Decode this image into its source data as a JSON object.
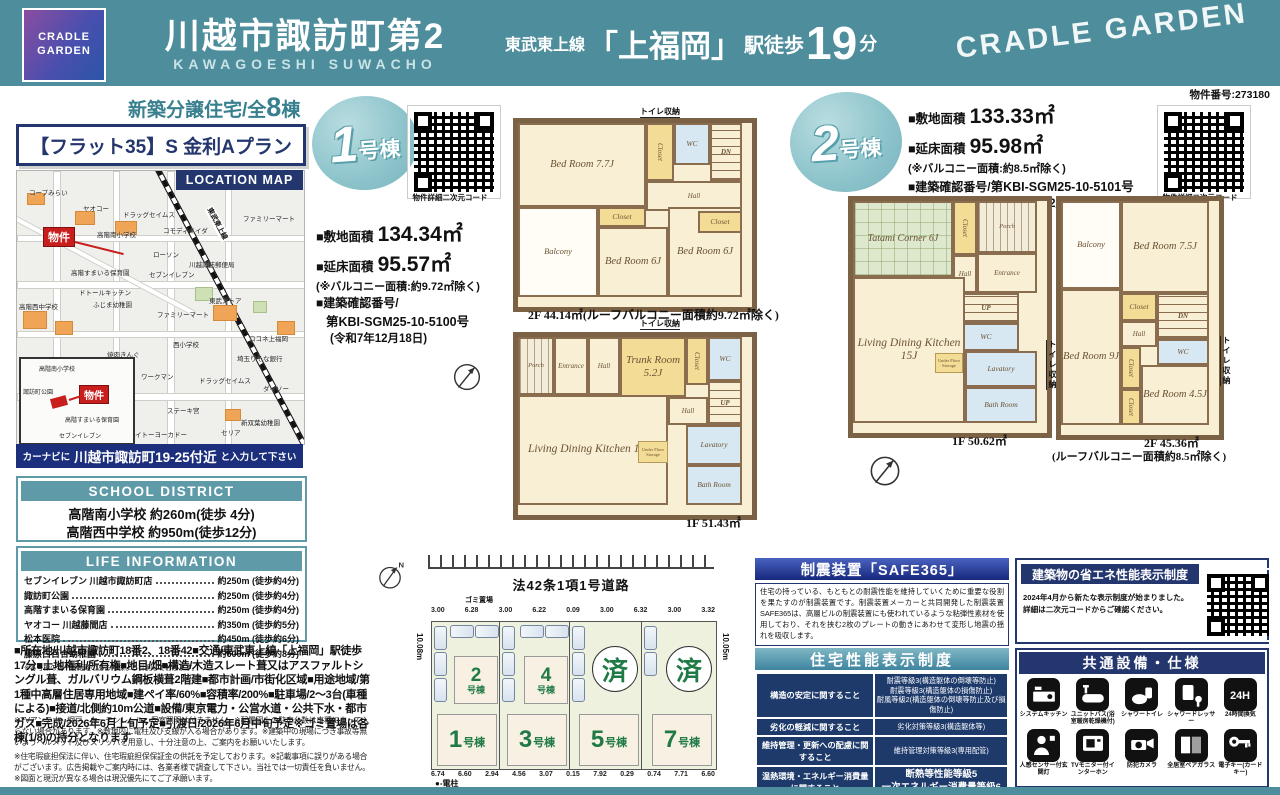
{
  "colors": {
    "teal": "#4e8e9c",
    "navy": "#24366e",
    "green": "#1f7a46",
    "red": "#c81e1e"
  },
  "header": {
    "logo_line1": "CRADLE",
    "logo_line2": "GARDEN",
    "title": "川越市諏訪町第2",
    "subtitle": "KAWAGOESHI SUWACHO",
    "rail": "東武東上線",
    "station": "「上福岡」",
    "walk": "駅徒歩",
    "min": "19",
    "unit": "分",
    "brand": "CRADLE GARDEN",
    "prop_no": "物件番号:273180"
  },
  "left": {
    "sale_prefix": "新築分譲住宅/全",
    "sale_count": "8",
    "sale_suffix": "棟",
    "flat35": "【フラット35】S 金利Aプラン",
    "map_tag": "LOCATION MAP",
    "bukken": "物件",
    "rail_label": "東武東上線",
    "navi_pre": "カーナビに",
    "navi_addr": "川越市諏訪町19-25付近",
    "navi_suf": "と入力して下さい"
  },
  "map": {
    "labels": [
      {
        "t": "コープみらい",
        "x": 12,
        "y": 16
      },
      {
        "t": "ヤオコー",
        "x": 66,
        "y": 32
      },
      {
        "t": "ドラッグセイムス",
        "x": 106,
        "y": 38
      },
      {
        "t": "コモディイイダ",
        "x": 146,
        "y": 54
      },
      {
        "t": "ファミリーマート",
        "x": 226,
        "y": 42
      },
      {
        "t": "高階南小学校",
        "x": 80,
        "y": 58
      },
      {
        "t": "高階すまいる保育園",
        "x": 54,
        "y": 96
      },
      {
        "t": "ローソン",
        "x": 136,
        "y": 78
      },
      {
        "t": "セブンイレブン",
        "x": 132,
        "y": 98
      },
      {
        "t": "川越諏訪郵便局",
        "x": 172,
        "y": 88
      },
      {
        "t": "ドトールキッチン",
        "x": 62,
        "y": 116
      },
      {
        "t": "ふじま幼稚園",
        "x": 76,
        "y": 128
      },
      {
        "t": "高階西中学校",
        "x": 2,
        "y": 130
      },
      {
        "t": "東武ストア",
        "x": 192,
        "y": 124
      },
      {
        "t": "ファミリーマート",
        "x": 140,
        "y": 138
      },
      {
        "t": "西小学校",
        "x": 156,
        "y": 168
      },
      {
        "t": "焼肉きんぐ",
        "x": 90,
        "y": 178
      },
      {
        "t": "ワークマン",
        "x": 124,
        "y": 200
      },
      {
        "t": "ドラッグセイムス",
        "x": 182,
        "y": 204
      },
      {
        "t": "ココネ上福岡",
        "x": 232,
        "y": 162
      },
      {
        "t": "埼玉りそな銀行",
        "x": 220,
        "y": 182
      },
      {
        "t": "ダイソー",
        "x": 246,
        "y": 212
      },
      {
        "t": "ステーキ宮",
        "x": 150,
        "y": 234
      },
      {
        "t": "イトーヨーカドー",
        "x": 118,
        "y": 258
      },
      {
        "t": "セリア",
        "x": 204,
        "y": 256
      },
      {
        "t": "新双葉幼稚園",
        "x": 224,
        "y": 246
      }
    ],
    "inset_labels": [
      {
        "t": "高階南小学校",
        "x": 18,
        "y": 5
      },
      {
        "t": "諏訪町公園",
        "x": 2,
        "y": 28
      },
      {
        "t": "高階すまいる保育園",
        "x": 44,
        "y": 56
      },
      {
        "t": "セブンイレブン",
        "x": 38,
        "y": 72
      }
    ],
    "buildings": [
      {
        "x": 10,
        "y": 22,
        "w": 16,
        "h": 10
      },
      {
        "x": 58,
        "y": 40,
        "w": 18,
        "h": 12
      },
      {
        "x": 98,
        "y": 50,
        "w": 20,
        "h": 12
      },
      {
        "x": 6,
        "y": 140,
        "w": 22,
        "h": 16
      },
      {
        "x": 38,
        "y": 150,
        "w": 16,
        "h": 12
      },
      {
        "x": 196,
        "y": 134,
        "w": 22,
        "h": 14
      },
      {
        "x": 260,
        "y": 150,
        "w": 16,
        "h": 12
      },
      {
        "x": 208,
        "y": 238,
        "w": 14,
        "h": 10
      },
      {
        "x": 58,
        "y": 246,
        "w": 14,
        "h": 10
      }
    ],
    "parks": [
      {
        "x": 178,
        "y": 116,
        "w": 16,
        "h": 12
      },
      {
        "x": 236,
        "y": 130,
        "w": 12,
        "h": 10
      }
    ]
  },
  "school": {
    "header": "SCHOOL DISTRICT",
    "items": [
      "高階南小学校 約260m(徒歩 4分)",
      "高階西中学校 約950m(徒歩12分)"
    ]
  },
  "life": {
    "header": "LIFE INFORMATION",
    "items": [
      {
        "name": "セブンイレブン 川越市諏訪町店",
        "dist": "約250m (徒歩約4分)"
      },
      {
        "name": "諏訪町公園",
        "dist": "約250m (徒歩約4分)"
      },
      {
        "name": "高階すまいる保育園",
        "dist": "約250m (徒歩約4分)"
      },
      {
        "name": "ヤオコー 川越藤間店",
        "dist": "約350m (徒歩約5分)"
      },
      {
        "name": "松本医院",
        "dist": "約450m (徒歩約6分)"
      },
      {
        "name": "藤原白百合幼稚園",
        "dist": "約600m (徒歩約8分)"
      }
    ],
    "note": "※各号棟の為一番距離のある号棟より計測しております。"
  },
  "details": "■所在地/川越市諏訪町18番2、18番42■交通/東武東上線「上福岡」駅徒歩17分■土地権利/所有権■地目/畑■構造/木造スレート葺又はアスファルトシングル葺、ガルバリウム鋼板横葺2階建■都市計画/市街化区域■用途地域/第1種中高層住居専用地域■建ペイ率/60%■容積率/200%■駐車場/2〜3台(車種による)■接道/北側約10m公道■設備/東京電力・公営水道・公共下水・都市ガス■完成/2026年6月上旬予定■引渡日/2026年6月中旬予定※ゴミ置場は各棟(1/8)の持分となります",
  "disclaimer1": "※TVアンテナ、網戸、カーテンレール、居室照明は付きません。※配置図上の駐車台数は車種によって入らない場合があります。※敷地内に電柱及び支線が入る場合があります。※建築中の現場につき事故等無いようヘルメット及びスリッパを用意し、十分注意の上、ご案内をお願いいたします。",
  "disclaimer2": "※住宅瑕疵担保法に伴い、住宅瑕疵担保保証金の供託を予定しております。※記載事項に誤りがある場合がございます。広告掲載やご案内時には、各業者様で調査して下さい。当社では一切責任を負いません。※図面と現況が異なる場合は現況優先にてご了承願います。",
  "unit1": {
    "badge_num": "1",
    "badge_suffix": "号棟",
    "qr_label": "物件詳細二次元コード",
    "land_label": "■敷地面積",
    "land": "134.34㎡",
    "floor_label": "■延床面積",
    "floor": "95.57㎡",
    "balcony_note": "(※バルコニー面積:約9.72㎡除く)",
    "permit_label": "■建築確認番号/",
    "permit": "第KBI-SGM25-10-5100号",
    "permit_date": "(令和7年12月18日)",
    "cap_2f": "2F 44.14㎡(ルーフバルコニー面積約9.72㎡除く)",
    "cap_1f": "1F 51.43㎡",
    "toilet": "トイレ収納"
  },
  "unit2": {
    "badge_num": "2",
    "badge_suffix": "号棟",
    "qr_label": "物件詳細二次元コード",
    "land_label": "■敷地面積",
    "land": "133.33㎡",
    "floor_label": "■延床面積",
    "floor": "95.98㎡",
    "balcony_note": "(※バルコニー面積:約8.5㎡除く)",
    "permit_label": "■建築確認番号/",
    "permit": "第KBI-SGM25-10-5101号",
    "permit_date": "(令和7年12月18日)",
    "cap_1f": "1F 50.62㎡",
    "cap_2f": "2F 45.36㎡",
    "cap_2f_note": "(ルーフバルコニー面積約8.5㎡除く)",
    "toilet": "トイレ収納"
  },
  "plans": {
    "u1f2": {
      "rooms": [
        {
          "n": "Bed Room 7.7J",
          "x": 0,
          "y": 0,
          "w": 128,
          "h": 84,
          "k": "big"
        },
        {
          "n": "Closet",
          "x": 128,
          "y": 0,
          "w": 28,
          "h": 58,
          "k": "closetv"
        },
        {
          "n": "WC",
          "x": 156,
          "y": 0,
          "w": 36,
          "h": 42,
          "k": "wc"
        },
        {
          "n": "DN",
          "x": 192,
          "y": 0,
          "w": 32,
          "h": 58,
          "k": "stairs"
        },
        {
          "n": "Hall",
          "x": 128,
          "y": 58,
          "w": 96,
          "h": 30,
          "k": "small"
        },
        {
          "n": "Balcony",
          "x": 0,
          "y": 84,
          "w": 80,
          "h": 90,
          "k": "balcony"
        },
        {
          "n": "Closet",
          "x": 80,
          "y": 84,
          "w": 48,
          "h": 20,
          "k": "closet"
        },
        {
          "n": "Bed Room 6J",
          "x": 80,
          "y": 104,
          "w": 70,
          "h": 70,
          "k": "big"
        },
        {
          "n": "Bed Room 6J",
          "x": 150,
          "y": 84,
          "w": 74,
          "h": 90,
          "k": "big"
        },
        {
          "n": "Closet",
          "x": 180,
          "y": 88,
          "w": 44,
          "h": 22,
          "k": "closet"
        }
      ]
    },
    "u1f1": {
      "rooms": [
        {
          "n": "Porch",
          "x": 0,
          "y": 0,
          "w": 36,
          "h": 58,
          "k": "stairsL"
        },
        {
          "n": "Entrance",
          "x": 36,
          "y": 0,
          "w": 34,
          "h": 58,
          "k": "small"
        },
        {
          "n": "Hall",
          "x": 70,
          "y": 0,
          "w": 32,
          "h": 58,
          "k": "small"
        },
        {
          "n": "Trunk Room 5.2J",
          "x": 102,
          "y": 0,
          "w": 66,
          "h": 60,
          "k": "trunk"
        },
        {
          "n": "Closet",
          "x": 168,
          "y": 0,
          "w": 22,
          "h": 48,
          "k": "closetv"
        },
        {
          "n": "WC",
          "x": 190,
          "y": 0,
          "w": 34,
          "h": 44,
          "k": "wc"
        },
        {
          "n": "UP",
          "x": 190,
          "y": 44,
          "w": 34,
          "h": 44,
          "k": "stairs"
        },
        {
          "n": "Hall",
          "x": 150,
          "y": 60,
          "w": 40,
          "h": 28,
          "k": "small"
        },
        {
          "n": "Living Dining Kitchen 11.2J",
          "x": 0,
          "y": 58,
          "w": 150,
          "h": 110,
          "k": "ldk"
        },
        {
          "n": "Under Floor Storage",
          "x": 120,
          "y": 104,
          "w": 30,
          "h": 22,
          "k": "furn"
        },
        {
          "n": "Lavatory",
          "x": 168,
          "y": 88,
          "w": 56,
          "h": 40,
          "k": "wc"
        },
        {
          "n": "Bath Room",
          "x": 168,
          "y": 128,
          "w": 56,
          "h": 40,
          "k": "wc"
        }
      ]
    },
    "u2f1": {
      "rooms": [
        {
          "n": "Tatami Corner 6J",
          "x": 0,
          "y": 0,
          "w": 100,
          "h": 76,
          "k": "tatami"
        },
        {
          "n": "Closet",
          "x": 100,
          "y": 0,
          "w": 24,
          "h": 54,
          "k": "closetv"
        },
        {
          "n": "Porch",
          "x": 124,
          "y": 0,
          "w": 60,
          "h": 52,
          "k": "stairsL"
        },
        {
          "n": "Entrance",
          "x": 124,
          "y": 52,
          "w": 60,
          "h": 40,
          "k": "small"
        },
        {
          "n": "Hall",
          "x": 100,
          "y": 54,
          "w": 24,
          "h": 38,
          "k": "small"
        },
        {
          "n": "UP",
          "x": 100,
          "y": 92,
          "w": 66,
          "h": 30,
          "k": "stairs"
        },
        {
          "n": "WC",
          "x": 100,
          "y": 122,
          "w": 66,
          "h": 28,
          "k": "wc"
        },
        {
          "n": "Lavatory",
          "x": 112,
          "y": 150,
          "w": 72,
          "h": 36,
          "k": "wc"
        },
        {
          "n": "Bath Room",
          "x": 112,
          "y": 186,
          "w": 72,
          "h": 36,
          "k": "wc"
        },
        {
          "n": "Living Dining Kitchen 15J",
          "x": 0,
          "y": 76,
          "w": 112,
          "h": 146,
          "k": "ldk"
        },
        {
          "n": "Under Floor Storage",
          "x": 82,
          "y": 152,
          "w": 28,
          "h": 20,
          "k": "furn"
        }
      ]
    },
    "u2f2": {
      "rooms": [
        {
          "n": "Balcony",
          "x": 0,
          "y": 0,
          "w": 60,
          "h": 88,
          "k": "balcony"
        },
        {
          "n": "Bed Room 7.5J",
          "x": 60,
          "y": 0,
          "w": 88,
          "h": 92,
          "k": "big"
        },
        {
          "n": "Closet",
          "x": 60,
          "y": 92,
          "w": 36,
          "h": 28,
          "k": "closet"
        },
        {
          "n": "DN",
          "x": 96,
          "y": 92,
          "w": 52,
          "h": 46,
          "k": "stairs"
        },
        {
          "n": "Hall",
          "x": 60,
          "y": 120,
          "w": 36,
          "h": 26,
          "k": "small"
        },
        {
          "n": "WC",
          "x": 96,
          "y": 138,
          "w": 52,
          "h": 26,
          "k": "wc"
        },
        {
          "n": "Bed Room 9J",
          "x": 0,
          "y": 88,
          "w": 60,
          "h": 136,
          "k": "big"
        },
        {
          "n": "Closet",
          "x": 60,
          "y": 146,
          "w": 20,
          "h": 42,
          "k": "closetv"
        },
        {
          "n": "Closet",
          "x": 60,
          "y": 188,
          "w": 20,
          "h": 36,
          "k": "closetv"
        },
        {
          "n": "Bed Room 4.5J",
          "x": 80,
          "y": 164,
          "w": 68,
          "h": 60,
          "k": "big"
        }
      ]
    }
  },
  "siteplan": {
    "north": "N",
    "road_label": "法42条1項1号道路",
    "trash_label": "ゴミ置場",
    "dim_left": "10.08m",
    "dim_right": "10.05m",
    "top_dims": [
      "3.00",
      "6.28",
      "3.00",
      "6.22",
      "0.09",
      "3.00",
      "6.32",
      "3.00",
      "3.32"
    ],
    "bottom_dims": [
      "6.74",
      "6.60",
      "2.94",
      "4.56",
      "3.07",
      "0.15",
      "7.92",
      "0.29",
      "0.74",
      "7.71",
      "6.60"
    ],
    "legend": "●-電柱",
    "cols": [
      {
        "upper_num": "2",
        "upper_suffix": "号棟",
        "lower_num": "1",
        "lower_suffix": "号棟"
      },
      {
        "upper_num": "4",
        "upper_suffix": "号棟",
        "lower_num": "3",
        "lower_suffix": "号棟"
      },
      {
        "sold_label": "済",
        "lower_num": "5",
        "lower_suffix": "号棟"
      },
      {
        "sold_label": "済",
        "lower_num": "7",
        "lower_suffix": "号棟"
      }
    ]
  },
  "safe365": {
    "header": "制震装置「SAFE365」",
    "body": "住宅の持っている、もともとの耐震性能を維持していくために重要な役割を果たすのが制震装置です。制震装置メーカーと共同開発した制震装置SAFE365は、高層ビルの制震装置にも使われているような粘弾性素材を使用しており、それを挟む2枚のプレートの動きにあわせて変形し地震の揺れを吸収します。"
  },
  "perf": {
    "header": "住宅性能表示制度",
    "rows": [
      {
        "label": "構造の安定に関すること",
        "value": "耐震等級3(構造躯体の倒壊等防止)\n耐震等級3(構造躯体の損傷防止)\n耐風等級2(構造躯体の倒壊等防止及び損傷防止)"
      },
      {
        "label": "劣化の軽減に関すること",
        "value": "劣化対策等級3(構造躯体等)"
      },
      {
        "label": "維持管理・更新への配慮に関すること",
        "value": "維持管理対策等級3(専用配管)"
      },
      {
        "label": "温熱環境・エネルギー消費量に関すること",
        "value": "断熱等性能等級5\n一次エネルギー消費量等級6"
      },
      {
        "label": "空気環境に関すること",
        "value": "ホルムアルデヒド発散等級3(内装・天井裏等)"
      }
    ]
  },
  "energy": {
    "header": "建築物の省エネ性能表示制度",
    "body": "2024年4月から新たな表示制度が始まりました。\n詳細は二次元コードからご確認ください。"
  },
  "equipment": {
    "header": "共通設備・仕様",
    "items": [
      {
        "label": "システムキッチン"
      },
      {
        "label": "ユニットバス(浴室暖房乾燥機付)"
      },
      {
        "label": "シャワートイレ"
      },
      {
        "label": "シャワードレッサー"
      },
      {
        "label": "24時間換気"
      },
      {
        "label": "人感センサー付玄関灯"
      },
      {
        "label": "TVモニター付インターホン"
      },
      {
        "label": "防犯カメラ"
      },
      {
        "label": "全居室ペアガラス"
      },
      {
        "label": "電子キー(カードキー)"
      }
    ]
  }
}
